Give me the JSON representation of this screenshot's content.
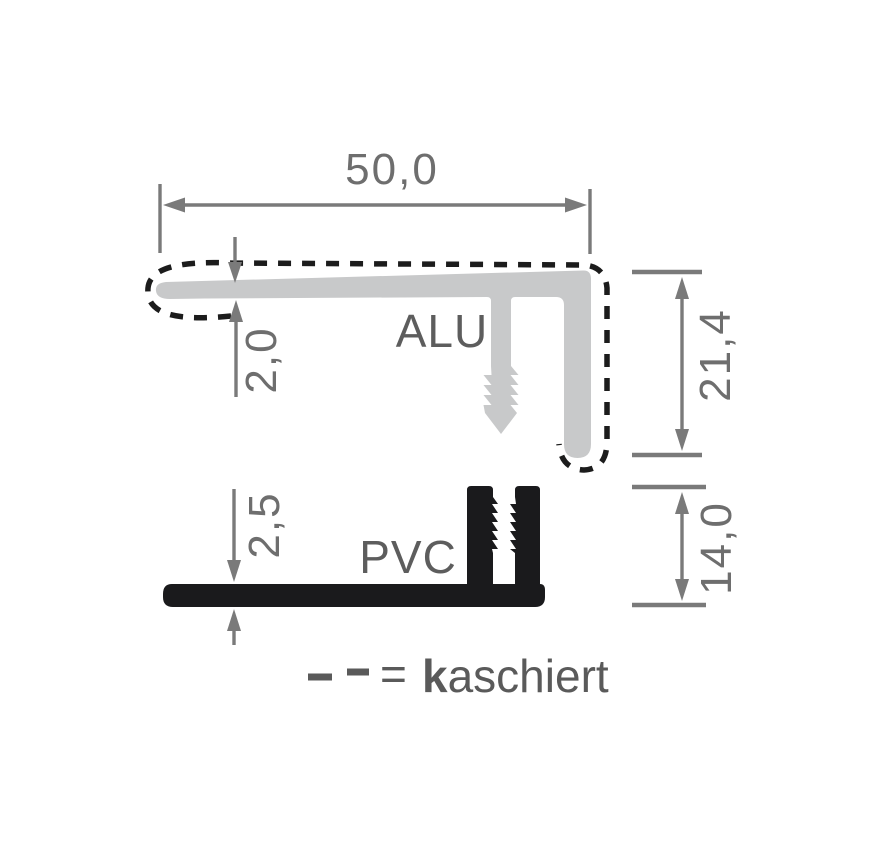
{
  "diagram": {
    "title_context": "Profile cross-section drawing",
    "dimensions": {
      "top_width": {
        "value": "50,0",
        "applies_to": "ALU profile top flange width"
      },
      "alu_thickness": {
        "value": "2,0",
        "applies_to": "ALU flange thickness"
      },
      "alu_height": {
        "value": "21,4",
        "applies_to": "ALU profile overall height"
      },
      "pvc_thickness": {
        "value": "2,5",
        "applies_to": "PVC base thickness"
      },
      "pvc_height": {
        "value": "14,0",
        "applies_to": "PVC profile overall height"
      }
    },
    "labels": {
      "alu": "ALU",
      "pvc": "PVC"
    },
    "legend": {
      "equals": "=",
      "term_bold_initial": "k",
      "term_rest": "aschiert",
      "meaning": "dashed outline = laminated (kaschiert)"
    }
  },
  "colors": {
    "alu_fill": "#c8c9ca",
    "pvc_fill": "#1a1a1c",
    "dimension_gray": "#7a7a7a",
    "text_gray": "#6e6e6e",
    "label_gray": "#5d5d5d",
    "dash_black": "#1c1c1c",
    "background": "#ffffff"
  },
  "icons": {
    "arrow_left": "dimension-arrow-left",
    "arrow_right": "dimension-arrow-right",
    "arrow_up": "dimension-arrow-up",
    "arrow_down": "dimension-arrow-down"
  }
}
